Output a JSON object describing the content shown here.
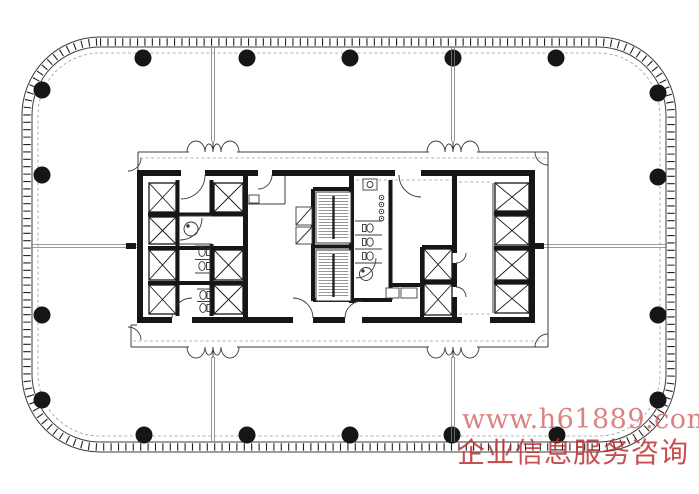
{
  "watermark": {
    "line1": "www.h61889.com",
    "line2": "企业信息服务咨询",
    "line1_color": "rgba(210,100,100,0.80)",
    "line2_color": "rgba(190,48,48,0.85)"
  },
  "drawing": {
    "background": "#ffffff",
    "ink": "#161616",
    "thin_line": "#3c3c3c",
    "partition_gray": "#7b7b7b",
    "column_radius": 8.5,
    "columns": [
      [
        143,
        58
      ],
      [
        247,
        58
      ],
      [
        350,
        58
      ],
      [
        453,
        58
      ],
      [
        556,
        58
      ],
      [
        144,
        435
      ],
      [
        247,
        435
      ],
      [
        350,
        435
      ],
      [
        452,
        435
      ],
      [
        557,
        435
      ],
      [
        42,
        90
      ],
      [
        42,
        175
      ],
      [
        42,
        315
      ],
      [
        42,
        400
      ],
      [
        658,
        93
      ],
      [
        658,
        177
      ],
      [
        658,
        315
      ],
      [
        658,
        400
      ]
    ],
    "partitions": [
      [
        213,
        47,
        213,
        141
      ],
      [
        453,
        47,
        453,
        141
      ],
      [
        213,
        357,
        213,
        442
      ],
      [
        453,
        357,
        453,
        442
      ],
      [
        31,
        246,
        137,
        246
      ],
      [
        535,
        246,
        667,
        246
      ]
    ],
    "entrances": [
      {
        "x": 213,
        "y": 152,
        "dir": "up"
      },
      {
        "x": 453,
        "y": 152,
        "dir": "up"
      },
      {
        "x": 213,
        "y": 347,
        "dir": "down"
      },
      {
        "x": 453,
        "y": 347,
        "dir": "down"
      }
    ],
    "elevators": [
      [
        149,
        183,
        27,
        29
      ],
      [
        149,
        217,
        27,
        27
      ],
      [
        149,
        250,
        27,
        30
      ],
      [
        149,
        285,
        27,
        29
      ],
      [
        214,
        183,
        29,
        29
      ],
      [
        214,
        250,
        29,
        30
      ],
      [
        214,
        285,
        29,
        29
      ],
      [
        424,
        249,
        28,
        31
      ],
      [
        424,
        284,
        28,
        31
      ],
      [
        495,
        183,
        34,
        28
      ],
      [
        495,
        216,
        34,
        29
      ],
      [
        495,
        250,
        34,
        30
      ],
      [
        495,
        284,
        34,
        29
      ]
    ],
    "stairs": [
      [
        316,
        192,
        35,
        51
      ],
      [
        316,
        250,
        35,
        51
      ]
    ]
  }
}
